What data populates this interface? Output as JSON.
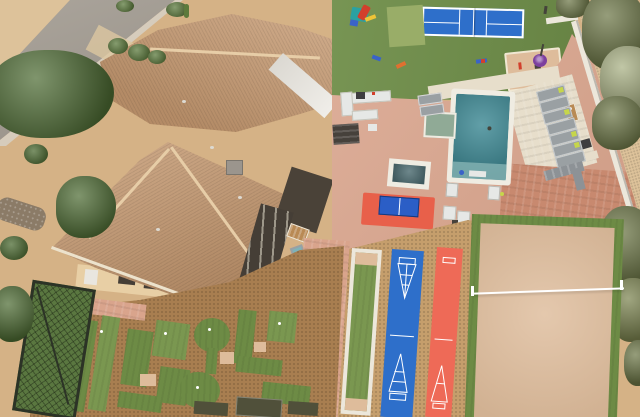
{
  "scene": {
    "description": "Aerial drone photo of a desert luxury estate backyard resort with sports amenities",
    "features": [
      "street",
      "desert-landscaping",
      "tile-roof-house",
      "pickleball-court",
      "playground",
      "swimming-pool",
      "baja-shelf",
      "hot-tub",
      "outdoor-kitchen",
      "sun-loungers",
      "ping-pong-table",
      "bocce-court",
      "shuffleboard-courts",
      "sand-volleyball-court",
      "putting-green-mini-golf",
      "batting-cage-net",
      "perimeter-wall",
      "desert-trees"
    ],
    "details": {
      "sun_loungers_right_row": 7,
      "shuffleboard_lanes": 2,
      "pickleball_courts": 1,
      "patio_chairs": 4
    },
    "palette": {
      "street": "#a19a90",
      "curb": "#d6ccbc",
      "desert": "#d5b286",
      "desert_far": "#ddc29a",
      "drive_pad": "#dcc7a0",
      "rock": "#8b7b67",
      "tree_dark": "#4e6c34",
      "tree_mid": "#5d7b3e",
      "tree_olive": "#6d7747",
      "tree_olive2": "#7c8450",
      "tree_bright": "#a9b184",
      "cactus": "#5c7a3c",
      "roof_tile": "#c89b72",
      "roof_ridge": "#e7cda7",
      "eave_light": "#ece2cc",
      "white_roof": "#e9e6df",
      "wall_sun": "#e8cfa5",
      "wall_white": "#ece7db",
      "dark_patio": "#4a4238",
      "dark_facade": "#453e36",
      "chimney": "#9b958d",
      "vent": "#dddad2",
      "lawn": "#6f8e49",
      "pad_green": "#99ad68",
      "court_blue": "#2e6fca",
      "line_white": "#ffffff",
      "paver_pink": "#d9a48c",
      "travertine": "#e7decb",
      "brick": "#c8896f",
      "cork": "#c59e6c",
      "pool_teal": "#3f8a95",
      "ledge": "#86b4b4",
      "coping": "#efece2",
      "baja": "#90aa96",
      "spa": "#4e6d72",
      "gravel": "#a87e50",
      "turf": "#6d8b45",
      "turf_light": "#7a9750",
      "sand": "#debc9b",
      "red_lane": "#ee6a57",
      "red_mat": "#e8604a",
      "table_blue": "#2b5ec6",
      "lime": "#c6d64b",
      "lounger": "#9aa0a3",
      "sofa": "#8d9296",
      "white_furn": "#e6e8e6",
      "dark_furn": "#46413b",
      "purple": "#7d3f9e",
      "teal_play": "#2ba1a1",
      "red_play": "#d23f2c",
      "yellow_play": "#eec437",
      "blue_play": "#3a63c8",
      "orange_toy": "#e07030",
      "cushion_teal": "#7fb2b8",
      "wood": "#b98a54",
      "cage_green": "#5a7740",
      "cage_frame": "#2c3326",
      "dark_mat": "#50503a",
      "grill_dark": "#3e3e40",
      "figure_dark": "#44433a"
    }
  }
}
